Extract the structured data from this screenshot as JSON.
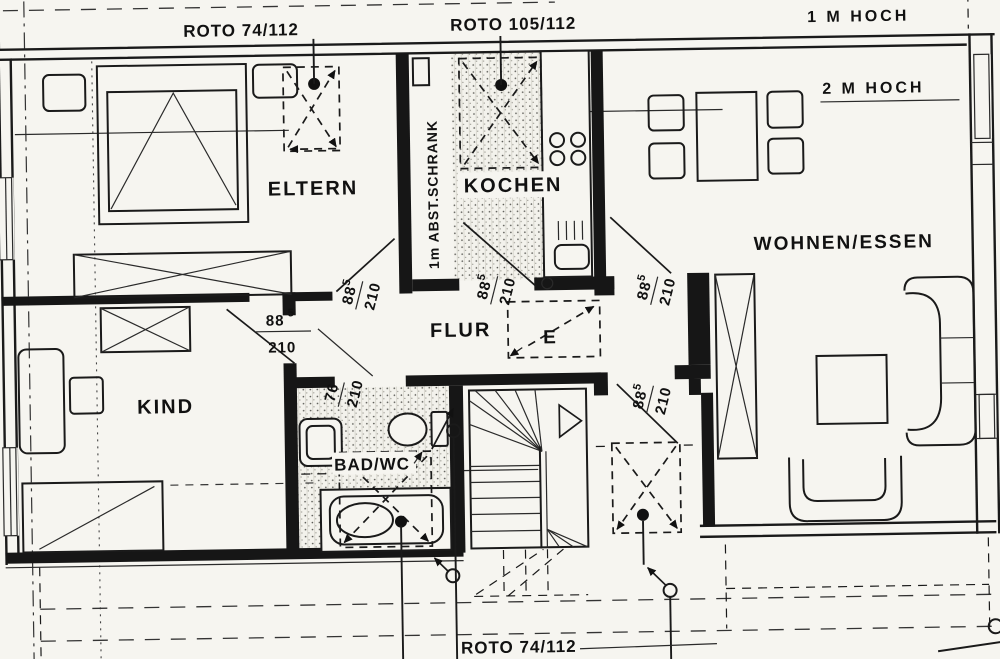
{
  "annotations": {
    "roto_top_left": "ROTO  74/112",
    "roto_top_mid": "ROTO 105/112",
    "roto_bottom": "ROTO 74/112",
    "height_1m": "1 M HOCH",
    "height_2m": "2 M HOCH"
  },
  "rooms": {
    "eltern": "ELTERN",
    "kochen": "KOCHEN",
    "wohnen_essen": "WOHNEN/ESSEN",
    "kind": "KIND",
    "flur": "FLUR",
    "bad_wc": "BAD/WC",
    "abstellschrank": "1m ABST.SCHRANK",
    "entry_marker": "E"
  },
  "door_dimensions": {
    "standard_width": "88",
    "standard_width_sup": "5",
    "standard_height": "210",
    "narrow_width": "76"
  },
  "colors": {
    "ink": "#1a1a1a",
    "paper": "#f6f5f0"
  }
}
